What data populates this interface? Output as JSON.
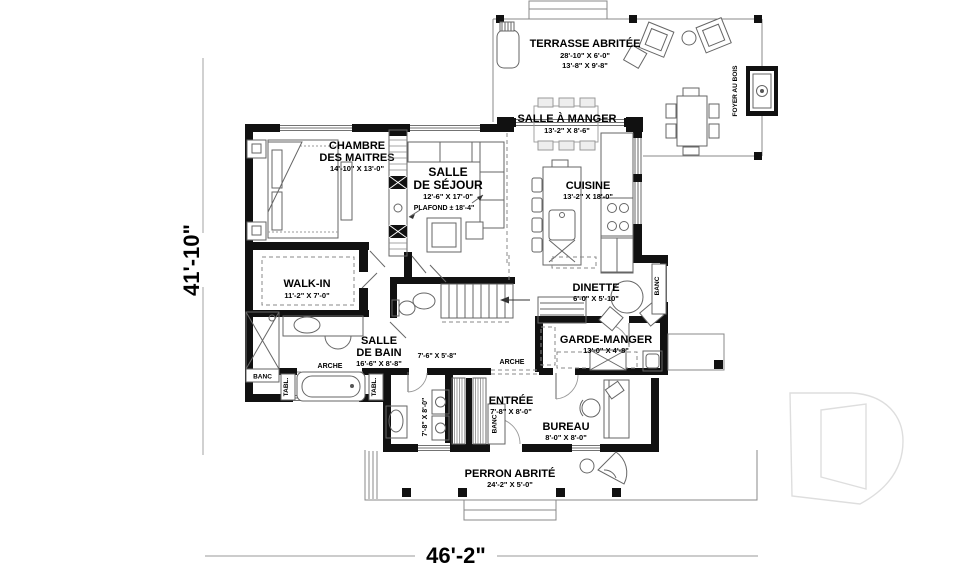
{
  "meta": {
    "drawing_type": "architectural floor plan",
    "language": "fr"
  },
  "overall_dims": {
    "width": "46'-2\"",
    "depth": "41'-10\""
  },
  "rooms": {
    "terrasse": {
      "name": "TERRASSE ABRITÉE",
      "dim1": "28'-10\" X 6'-0\"",
      "dim2": "13'-8\" X 9'-8\""
    },
    "salle_a_manger": {
      "name": "SALLE À MANGER",
      "dim": "13'-2\" X 8'-6\""
    },
    "cuisine": {
      "name": "CUISINE",
      "dim": "13'-2\" X 18'-0\""
    },
    "chambre": {
      "line1": "CHAMBRE",
      "line2": "DES MAITRES",
      "dim": "14'-10\" X 13'-0\""
    },
    "sejour": {
      "line1": "SALLE",
      "line2": "DE SÉJOUR",
      "dim": "12'-6\" X 17'-0\"",
      "ceiling": "PLAFOND ± 18'-4\""
    },
    "walk_in": {
      "name": "WALK-IN",
      "dim": "11'-2\" X 7'-0\""
    },
    "salle_de_bain": {
      "line1": "SALLE",
      "line2": "DE BAIN",
      "dim": "16'-6\" X 8'-8\""
    },
    "wc": {
      "dim": "7'-6\" X 5'-8\""
    },
    "buanderie": {
      "dim": "7'-8\" X 8'-0\""
    },
    "dinette": {
      "name": "DINETTE",
      "dim": "6'-0\" X 5'-10\""
    },
    "garde_manger": {
      "name": "GARDE-MANGER",
      "dim": "13'-0\" X 4'-8\""
    },
    "entree": {
      "name": "ENTRÉE",
      "dim": "7'-8\" X 8'-0\""
    },
    "bureau": {
      "name": "BUREAU",
      "dim": "8'-0\" X 8'-0\""
    },
    "perron": {
      "name": "PERRON ABRITÉ",
      "dim": "24'-2\" X 5'-0\""
    }
  },
  "annotations": {
    "foyer_au_bois": "FOYER AU BOIS",
    "arche": "ARCHE",
    "banc": "BANC",
    "tablette": "TABL."
  },
  "colors": {
    "walls": "#111111",
    "lines": "#777777",
    "background": "#ffffff",
    "watermark": "#dedede"
  }
}
